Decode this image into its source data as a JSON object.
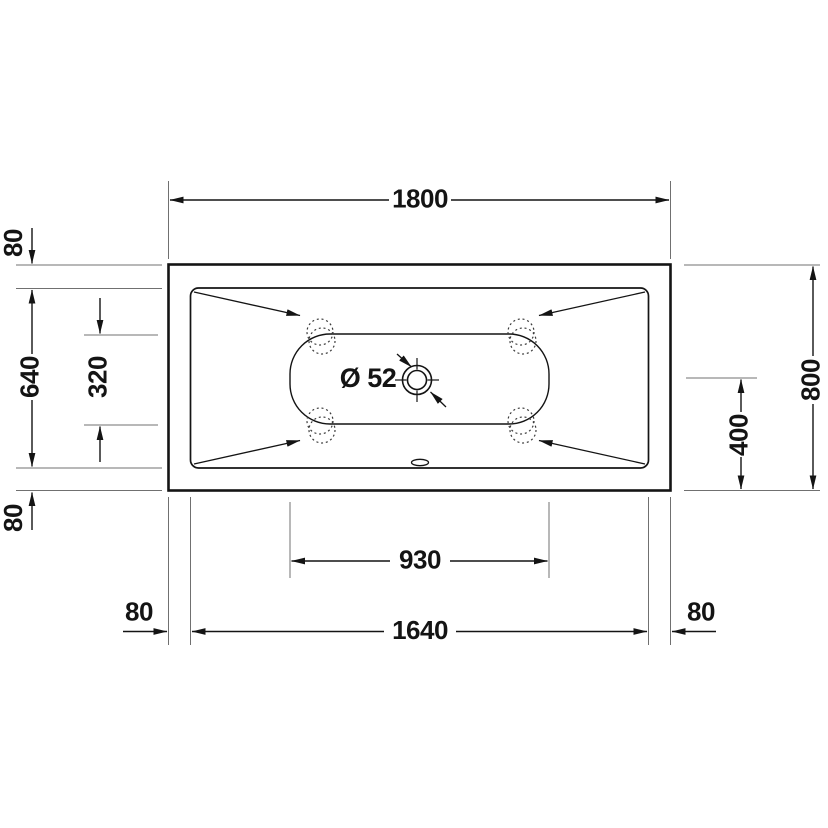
{
  "drawing": {
    "description": "Technical plan-view drawing of a rectangular whirlpool bathtub with dimension lines",
    "unit": "mm",
    "labels": {
      "overall_length": "1800",
      "overall_width": "800",
      "rim_width_top": "80",
      "rim_width_bottom": "80",
      "rim_width_left": "80",
      "rim_width_right": "80",
      "inner_width": "640",
      "jet_row_spacing": "320",
      "center_offset": "400",
      "floor_length": "930",
      "inner_length": "1640",
      "drain_diameter": "Ø 52"
    },
    "colors": {
      "object_line": "#141414",
      "extension_line": "#707070",
      "background": "#ffffff"
    }
  }
}
